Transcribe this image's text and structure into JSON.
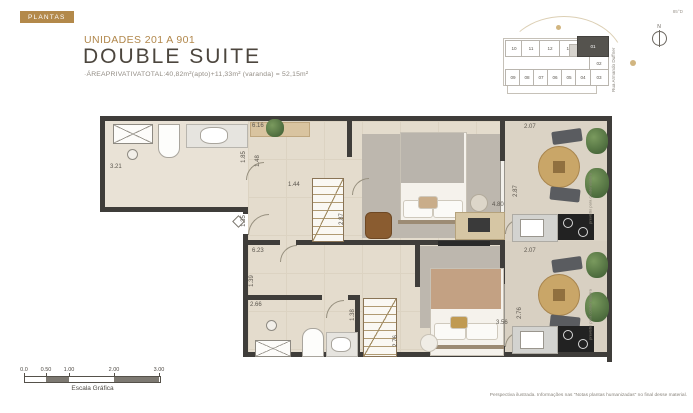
{
  "page": {
    "badge": "PLANTAS",
    "corner_note": "85°D",
    "title_small": "UNIDADES 201 A 901",
    "title_large": "DOUBLE SUITE",
    "area_line": "·ÁREAPRIVATIVATOTAL:40,82m²(apto)+11,33m² (varanda) = 52,15m²",
    "footer_note": "Perspectiva ilustrada. Informações nas \"Notas plantas humanizadas\" no final desse material."
  },
  "colors": {
    "accent_gold": "#b1874b",
    "title_dark": "#4c463e",
    "wall": "#3f3d3a",
    "floor_beige": "#e4dccd",
    "balcony_floor": "#dbd3c5",
    "carpet_gray": "#bdb7ae",
    "keyplan_highlight": "#55534e"
  },
  "keyplan": {
    "street_label": "Rua Armando Duffner",
    "compass_label": "N",
    "cells": [
      {
        "label": "10",
        "x": 2,
        "y": 4,
        "w": 16,
        "h": 15
      },
      {
        "label": "11",
        "x": 18,
        "y": 4,
        "w": 18,
        "h": 15
      },
      {
        "label": "12",
        "x": 36,
        "y": 4,
        "w": 20,
        "h": 15
      },
      {
        "label": "13",
        "x": 56,
        "y": 4,
        "w": 18,
        "h": 15
      },
      {
        "label": "",
        "x": 66,
        "y": 8,
        "w": 8,
        "h": 11,
        "shaded": true
      },
      {
        "label": "01",
        "x": 74,
        "y": 0,
        "w": 30,
        "h": 19,
        "hl": true
      },
      {
        "label": "02",
        "x": 86,
        "y": 19,
        "w": 18,
        "h": 14
      },
      {
        "label": "03",
        "x": 86,
        "y": 33,
        "w": 18,
        "h": 15
      },
      {
        "label": "09",
        "x": 2,
        "y": 33,
        "w": 14,
        "h": 15
      },
      {
        "label": "08",
        "x": 16,
        "y": 33,
        "w": 14,
        "h": 15
      },
      {
        "label": "07",
        "x": 30,
        "y": 33,
        "w": 14,
        "h": 15
      },
      {
        "label": "06",
        "x": 44,
        "y": 33,
        "w": 14,
        "h": 15
      },
      {
        "label": "05",
        "x": 58,
        "y": 33,
        "w": 14,
        "h": 15
      },
      {
        "label": "04",
        "x": 72,
        "y": 33,
        "w": 14,
        "h": 15
      }
    ]
  },
  "plan": {
    "balcony_note": "previsão para condensadora",
    "dims": [
      {
        "t": "3.21",
        "x": 10,
        "y": 48,
        "v": false
      },
      {
        "t": "6.16",
        "x": 152,
        "y": 7,
        "v": false
      },
      {
        "t": "1.85",
        "x": 138,
        "y": 38,
        "v": true
      },
      {
        "t": "1.48",
        "x": 152,
        "y": 42,
        "v": true
      },
      {
        "t": "1.44",
        "x": 188,
        "y": 66,
        "v": false
      },
      {
        "t": "2.87",
        "x": 236,
        "y": 100,
        "v": true
      },
      {
        "t": "1.35",
        "x": 138,
        "y": 102,
        "v": true
      },
      {
        "t": "6.23",
        "x": 152,
        "y": 132,
        "v": false
      },
      {
        "t": "1.39",
        "x": 146,
        "y": 162,
        "v": true
      },
      {
        "t": "2.66",
        "x": 150,
        "y": 186,
        "v": false
      },
      {
        "t": "1.38",
        "x": 247,
        "y": 196,
        "v": true
      },
      {
        "t": "2.76",
        "x": 290,
        "y": 222,
        "v": true
      },
      {
        "t": "2.07",
        "x": 424,
        "y": 8,
        "v": false
      },
      {
        "t": "2.87",
        "x": 410,
        "y": 72,
        "v": true
      },
      {
        "t": "4.80",
        "x": 392,
        "y": 86,
        "v": false
      },
      {
        "t": "2.07",
        "x": 424,
        "y": 132,
        "v": false
      },
      {
        "t": "2.76",
        "x": 414,
        "y": 194,
        "v": true
      },
      {
        "t": "3.56",
        "x": 396,
        "y": 204,
        "v": false
      }
    ]
  },
  "scalebar": {
    "label": "Escala Gráfica",
    "ticks": [
      {
        "label": "0.0",
        "pos": 0
      },
      {
        "label": "0.50",
        "pos": 22
      },
      {
        "label": "1.00",
        "pos": 45
      },
      {
        "label": "2.00",
        "pos": 90
      },
      {
        "label": "3.00",
        "pos": 135
      }
    ],
    "segments": [
      {
        "x": 22,
        "w": 23
      },
      {
        "x": 90,
        "w": 45
      }
    ]
  }
}
